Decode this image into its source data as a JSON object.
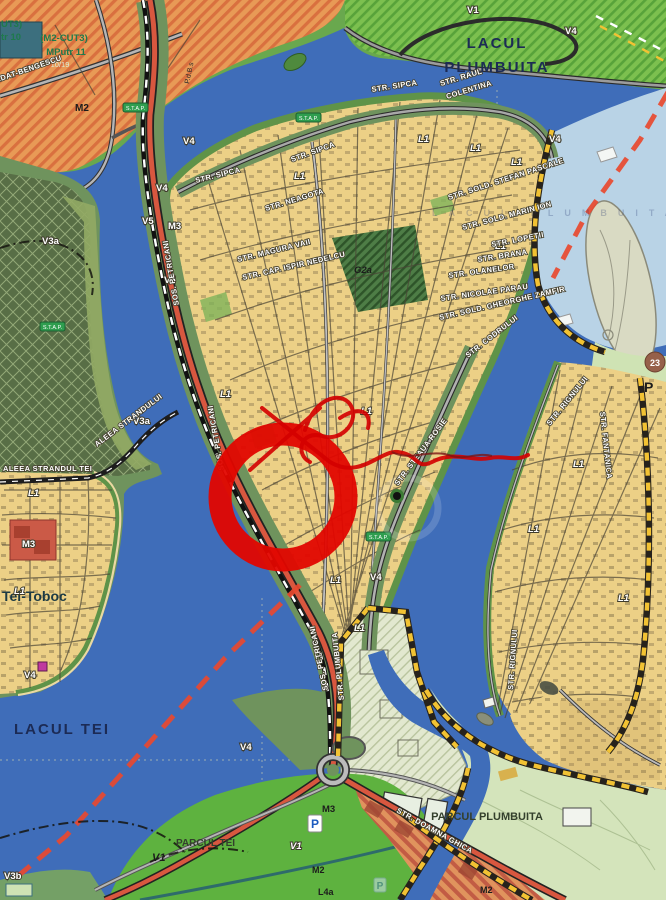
{
  "map": {
    "water": {
      "lacul_plumbuita_1": "LACUL",
      "lacul_plumbuita_2": "PLUMBUITA",
      "lacul_tei": "LACUL TEI",
      "ghost_label": "LACUL PLUMBUITA"
    },
    "districts": {
      "tei_toboc": "Tei-Toboc",
      "parcul_plumbuita": "PARCUL PLUMBUITA",
      "parcul_tei": "PARCUL TEI"
    },
    "zones": {
      "m2_cut3": "(M2-CUT3)",
      "mputr_11": "MPutr 11",
      "ratio_10_19": "10/19",
      "m2": "M2",
      "frag_ut3": "UT3)",
      "frag_tr10": "tr 10",
      "m3": "M3",
      "v1": "V1",
      "v3a": "V3a",
      "v3b": "V3b",
      "v4": "V4",
      "v5": "V5",
      "g2a": "G2a",
      "l1": "L1",
      "l4a": "L4a",
      "p_fragment": "P",
      "badge_23": "23",
      "pdbs": "P.d.B.s"
    },
    "streets": {
      "sipca": "STR. SIPCA",
      "raul_colentina_1": "STR. RAUL",
      "raul_colentina_2": "COLENTINA",
      "neagota": "STR. NEAGOTA",
      "magura_vaii": "STR. MAGURA VAII",
      "cap_ispir": "STR. CAP. ISPIR NEDELCU",
      "stefan_pascale": "STR. SOLD. STEFAN PASCALE",
      "marin_ion": "STR. SOLD. MARIN ION",
      "lopetii": "STR. LOPETII",
      "brana": "STR. BRANA",
      "olanelor": "STR. OLANELOR",
      "steaua_rosie": "STR. STEAUA ROSIE",
      "nicolae_parau": "STR. NICOLAE PARAU",
      "gheorghe_zamfir": "STR. SOLD. GHEORGHE ZAMFIR",
      "codrului": "STR. CODRULUI",
      "rignului": "STR. RIGNULUI",
      "fantanica": "STR. FANTANICA",
      "petricani": "SOS. PETRICANI",
      "plumbuita_street": "STR. PLUMBUITA",
      "doamna_ghica": "STR. DOAMNA GHICA",
      "papadat_bengescu": "HORTENSIA PAPADAT-BENGESCU",
      "aleea_strandul_tei": "ALEEA STRANDUL TEI",
      "aleea_strandului": "ALEEA STRANDULUI"
    },
    "badges": {
      "stap": "S.T.A.P.",
      "parking_p": "P"
    },
    "annotation": {
      "type": "hand-drawn red marker circle with pen scribble",
      "color": "#e10600"
    },
    "colors": {
      "water": "#3f6db9",
      "residential_yellow": "#ecd086",
      "industrial_orange": "#e89a56",
      "green_v_zone": "#69a84e",
      "dark_green_forest": "#586e46",
      "park_light_green": "#d4e4bb",
      "park_bright_green": "#5eb23f",
      "protected_light_blue": "#b9d3e6",
      "red_road": "#d8573f",
      "m3_red": "#cb5a47",
      "boundary_yellow": "#f2c233",
      "red_dash_boundary": "#e8492f"
    }
  }
}
